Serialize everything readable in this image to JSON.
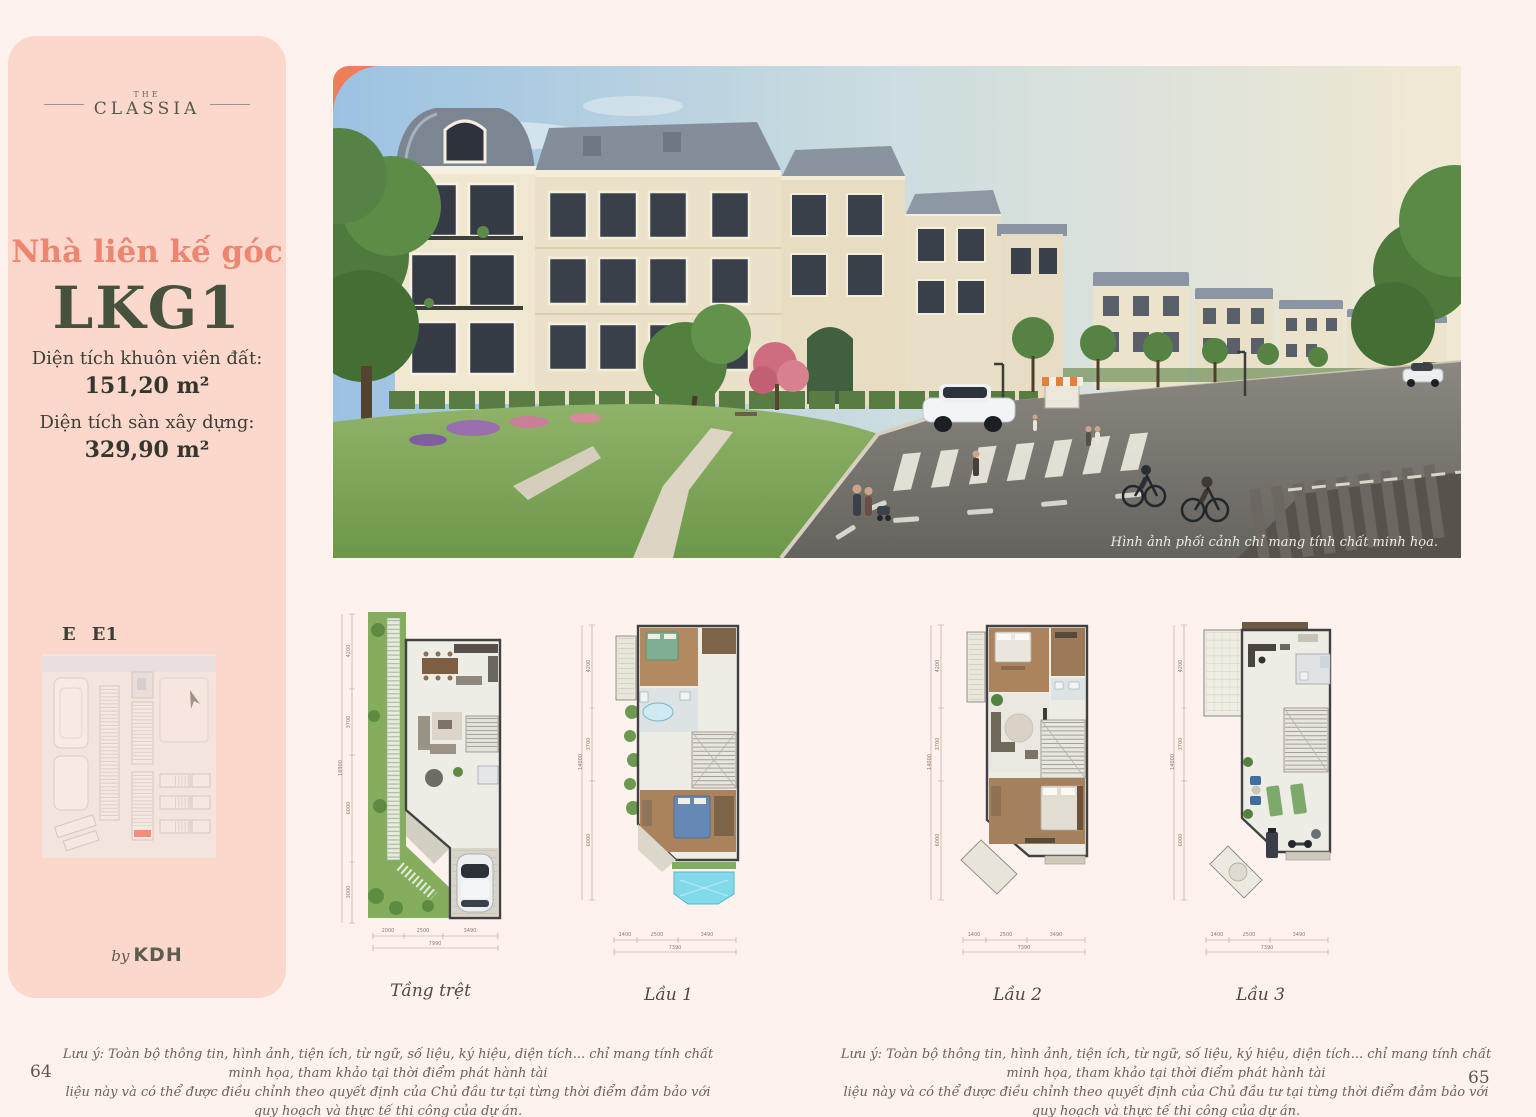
{
  "page": {
    "left_number": "64",
    "right_number": "65"
  },
  "colors": {
    "page_bg": "#fdf2ee",
    "sidebar_bg": "#fbd8cb",
    "accent_coral": "#ee8570",
    "accent_green": "#46523e",
    "hero_corner_accent": "#ef7c5a",
    "map_highlight": "#e2553e"
  },
  "icons": {
    "north_arrow": "➤"
  },
  "sidebar": {
    "brand_the": "THE",
    "brand_classia": "CLASSIA",
    "subtitle": "Nhà liên kế góc",
    "unit_code": "LKG1",
    "land_area_label": "Diện tích khuôn viên đất:",
    "land_area_value": "151,20 m²",
    "floor_area_label": "Diện tích sàn xây dựng:",
    "floor_area_value": "329,90 m²",
    "map_block_label": "E",
    "map_unit_label": "E1",
    "logo_by": "by",
    "logo_brand": "KDH"
  },
  "hero": {
    "caption": "Hình ảnh phối cảnh chỉ mang tính chất minh họa."
  },
  "floor_plans": [
    {
      "label": "Tầng trệt",
      "dims_bottom": [
        "2000",
        "2500",
        "3490"
      ],
      "dim_total": "7990",
      "dims_left": [
        "4200",
        "3700",
        "6000",
        "3000"
      ],
      "dim_left_total": "16900"
    },
    {
      "label": "Lầu 1",
      "dims_bottom": [
        "1400",
        "2500",
        "3490"
      ],
      "dim_total": "7390",
      "dims_left": [
        "4200",
        "3700",
        "6000"
      ],
      "dim_left_total": "14000"
    },
    {
      "label": "Lầu 2",
      "dims_bottom": [
        "1400",
        "2500",
        "3490"
      ],
      "dim_total": "7390",
      "dims_left": [
        "4200",
        "3700",
        "6000"
      ],
      "dim_left_total": "14000"
    },
    {
      "label": "Lầu 3",
      "dims_bottom": [
        "1400",
        "2500",
        "3490"
      ],
      "dim_total": "7390",
      "dims_left": [
        "4200",
        "3700",
        "6000"
      ],
      "dim_left_total": "14000"
    }
  ],
  "disclaimer": {
    "line1": "Lưu ý: Toàn bộ thông tin, hình ảnh, tiện ích, từ ngữ, số liệu, ký hiệu, diện tích... chỉ mang tính chất minh họa, tham khảo tại thời điểm phát hành tài",
    "line2": "liệu này và có thể được điều chỉnh theo quyết định của Chủ đầu tư tại từng thời điểm đảm bảo với quy hoạch và thực tế thi công của dự án.",
    "line3": "Thông tin chính xác sẽ căn cứ trên hợp đồng mua bán."
  }
}
